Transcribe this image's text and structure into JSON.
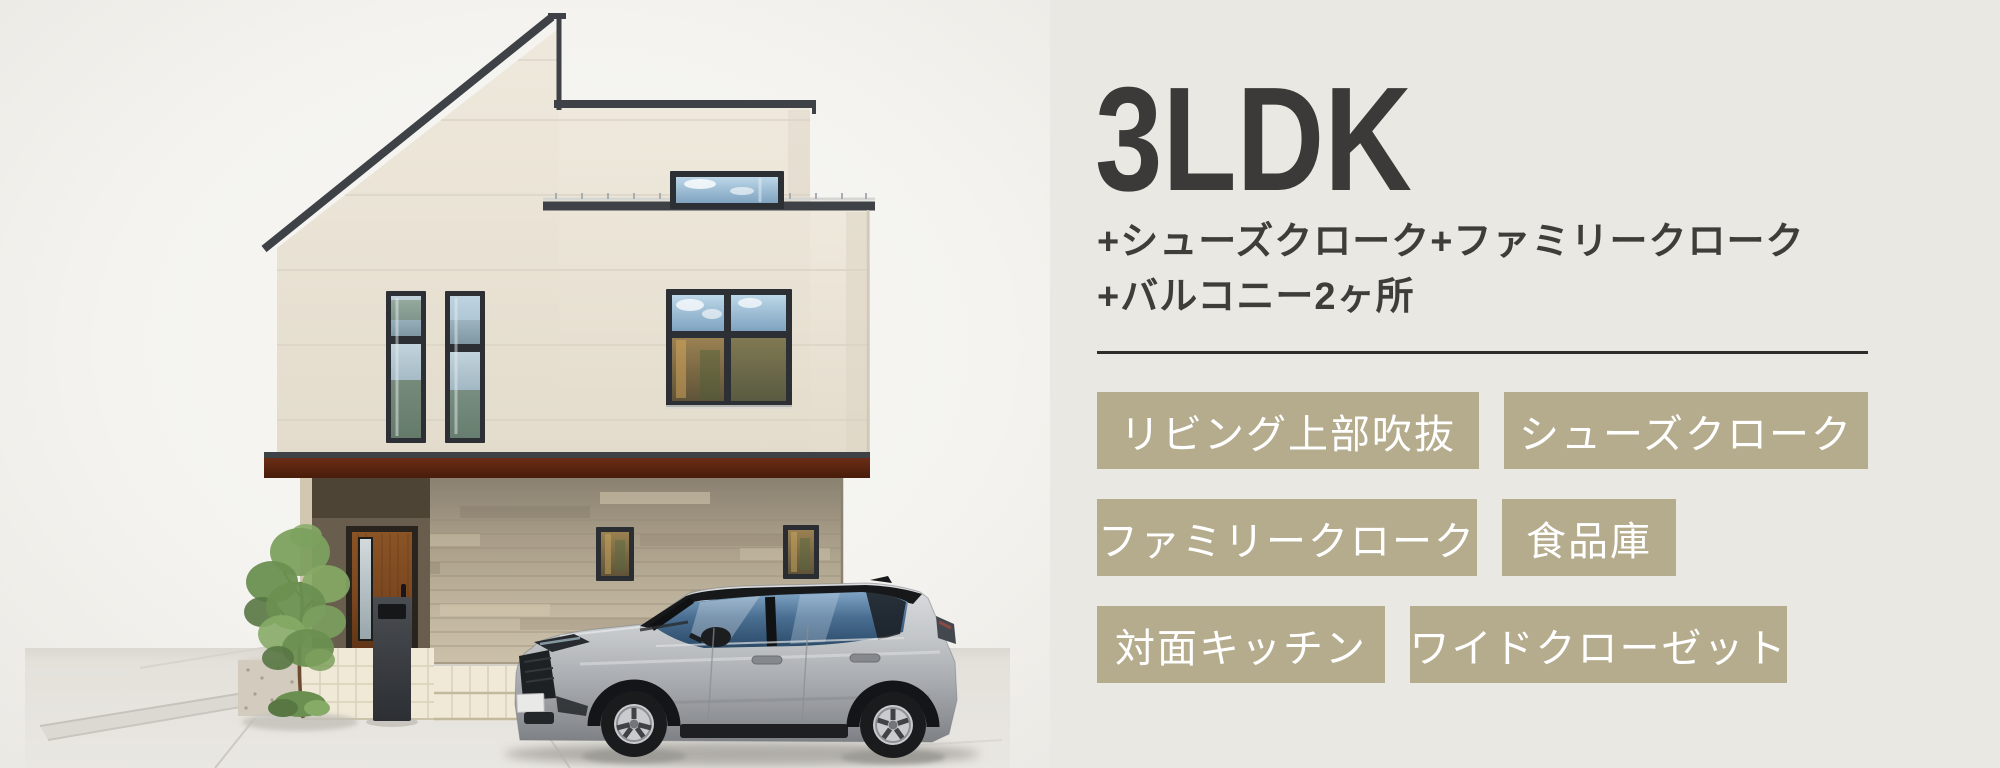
{
  "header": {
    "title": "3LDK",
    "subtitle_line1": "+シューズクローク+ファミリークローク",
    "subtitle_line2": "+バルコニー2ヶ所"
  },
  "features": {
    "items": [
      {
        "label": "リビング上部吹抜"
      },
      {
        "label": "シューズクローク"
      },
      {
        "label": "ファミリークローク"
      },
      {
        "label": "食品庫"
      },
      {
        "label": "対面キッチン"
      },
      {
        "label": "ワイドクローゼット"
      }
    ]
  },
  "illustration": {
    "subject": "3-story house exterior with silver SUV parked in driveway",
    "elements": [
      "house",
      "entrance-door",
      "delivery-post",
      "tree",
      "car",
      "driveway"
    ]
  },
  "colors": {
    "background": "#eae8e3",
    "accent_tan": "#b5ac8e",
    "heading_text": "#3b3a38",
    "badge_text": "#ffffff",
    "divider": "#2d2d2c",
    "band_maroon": "#5a2214",
    "wall_cream": "#e9e2d4",
    "roof_trim": "#3e4246"
  }
}
